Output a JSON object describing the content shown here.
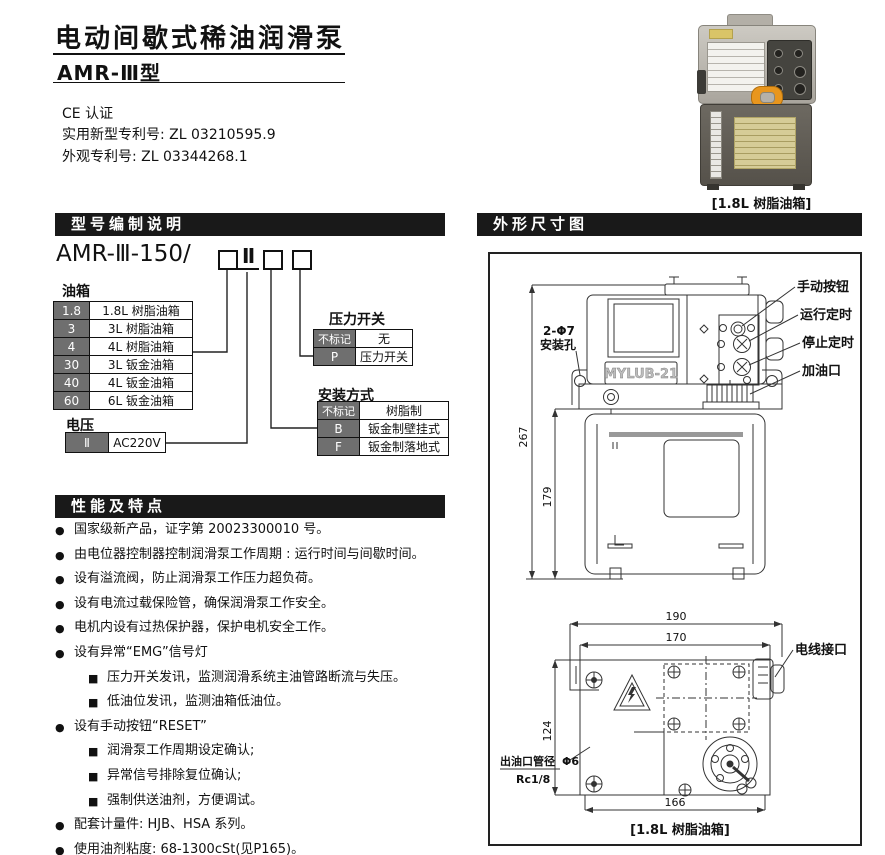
{
  "page": {
    "title": "电动间歇式稀油润滑泵",
    "model": "AMR-Ⅲ型",
    "cert": "CE 认证",
    "patent_utility": "实用新型专利号: ZL 03210595.9",
    "patent_design": "外观专利号: ZL 03344268.1"
  },
  "photo": {
    "caption": "[1.8L 树脂油箱]"
  },
  "colors": {
    "section_bar": "#191919",
    "table_code_bg": "#6f6f6f",
    "cap_orange": "#e8961e",
    "tank_gray": "#5f5b54",
    "label_yellow": "#d6cc97"
  },
  "model_section": {
    "header": "型号编制说明",
    "code_prefix": "AMR-Ⅲ-150/",
    "code_voltage": "Ⅱ",
    "tank": {
      "label": "油箱",
      "rows": [
        {
          "code": "1.8",
          "desc": "1.8L 树脂油箱"
        },
        {
          "code": "3",
          "desc": "3L 树脂油箱"
        },
        {
          "code": "4",
          "desc": "4L 树脂油箱"
        },
        {
          "code": "30",
          "desc": "3L 钣金油箱"
        },
        {
          "code": "40",
          "desc": "4L 钣金油箱"
        },
        {
          "code": "60",
          "desc": "6L 钣金油箱"
        }
      ]
    },
    "voltage": {
      "label": "电压",
      "rows": [
        {
          "code": "Ⅱ",
          "desc": "AC220V"
        }
      ]
    },
    "pressure": {
      "label": "压力开关",
      "rows": [
        {
          "code": "不标记",
          "desc": "无"
        },
        {
          "code": "P",
          "desc": "压力开关"
        }
      ]
    },
    "mounting": {
      "label": "安装方式",
      "rows": [
        {
          "code": "不标记",
          "desc": "树脂制"
        },
        {
          "code": "B",
          "desc": "钣金制壁挂式"
        },
        {
          "code": "F",
          "desc": "钣金制落地式"
        }
      ]
    }
  },
  "features": {
    "header": "性能及特点",
    "bullet_solid": "●",
    "bullet_square": "■",
    "items": [
      {
        "level": 1,
        "text": "国家级新产品，证字第 20023300010 号。"
      },
      {
        "level": 1,
        "text": "由电位器控制器控制润滑泵工作周期 : 运行时间与间歇时间。"
      },
      {
        "level": 1,
        "text": "设有溢流阀，防止润滑泵工作压力超负荷。"
      },
      {
        "level": 1,
        "text": "设有电流过载保险管，确保润滑泵工作安全。"
      },
      {
        "level": 1,
        "text": "电机内设有过热保护器，保护电机安全工作。"
      },
      {
        "level": 1,
        "text": "设有异常“EMG”信号灯"
      },
      {
        "level": 2,
        "text": "压力开关发讯，监测润滑系统主油管路断流与失压。"
      },
      {
        "level": 2,
        "text": "低油位发讯，监测油箱低油位。"
      },
      {
        "level": 1,
        "text": "设有手动按钮“RESET”"
      },
      {
        "level": 2,
        "text": "润滑泵工作周期设定确认;"
      },
      {
        "level": 2,
        "text": "异常信号排除复位确认;"
      },
      {
        "level": 2,
        "text": "强制供送油剂，方便调试。"
      },
      {
        "level": 1,
        "text": "配套计量件: HJB、HSA 系列。"
      },
      {
        "level": 1,
        "text": "使用油剂粘度: 68-1300cSt(见P165)。"
      }
    ]
  },
  "diagram": {
    "header": "外形尺寸图",
    "brand": "MYLUB-21",
    "caption": "[1.8L 树脂油箱]",
    "labels": {
      "manual_button": "手动按钮",
      "run_timer": "运行定时",
      "stop_timer": "停止定时",
      "fill_port": "加油口",
      "mount_holes_line1": "2-Φ7",
      "mount_holes_line2": "安装孔",
      "wire_port": "电线接口",
      "outlet_line1": "出油口管径",
      "outlet_phi": "Φ6",
      "outlet_line2": "Rc1/8"
    },
    "dims": {
      "h_total": "267",
      "h_tank": "179",
      "w_outer": "190",
      "w_inner": "170",
      "depth": "124",
      "w_bottom": "166"
    }
  }
}
